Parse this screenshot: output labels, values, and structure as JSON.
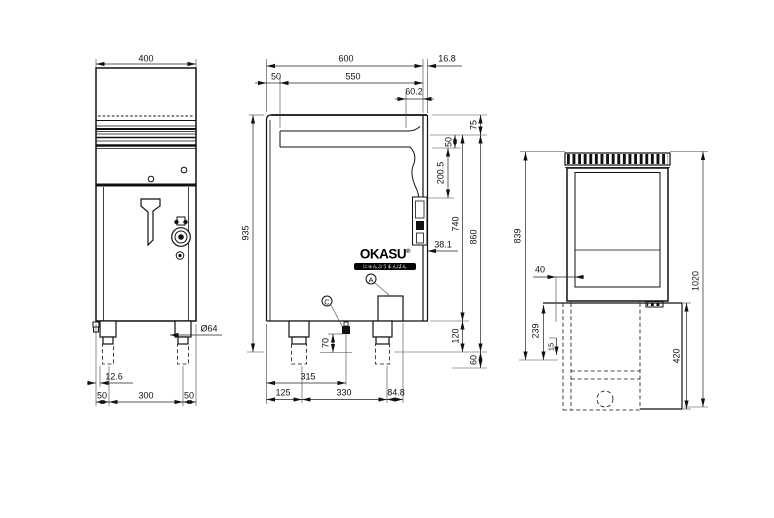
{
  "page": {
    "background": "#ffffff",
    "line_color": "#111111"
  },
  "watermark": {
    "brand": "OKASU",
    "registered_mark": "®",
    "banner_text": "にゅんぶうまんばん"
  },
  "front_view": {
    "top_width": "400",
    "leg_diameter": "Ø64",
    "leg_inset": "12.6",
    "bottom_chain": [
      "50",
      "300",
      "50"
    ]
  },
  "side_view": {
    "top_total_width": "600",
    "back_panel_thickness": "16.8",
    "front_overhang": "50",
    "worktop_depth": "550",
    "back_gap": "60.2",
    "rim_height": "75",
    "step_height": "50",
    "upper_section_height": "200.5",
    "body_height": "740",
    "height_to_plinth": "860",
    "overall_height": "935",
    "gas_pipe_offset": "38.1",
    "plinth_height": "120",
    "foot_height": "60",
    "connection_height": "70",
    "connection_distance": "315",
    "bottom_chain": [
      "125",
      "330",
      "84.8"
    ],
    "callout_a": "A",
    "callout_c": "C"
  },
  "rear_view": {
    "panel_inset": "40",
    "upper_height": "839",
    "box_height": "239",
    "small_offset": "15",
    "pedestal_height": "420",
    "overall_height": "1020"
  }
}
